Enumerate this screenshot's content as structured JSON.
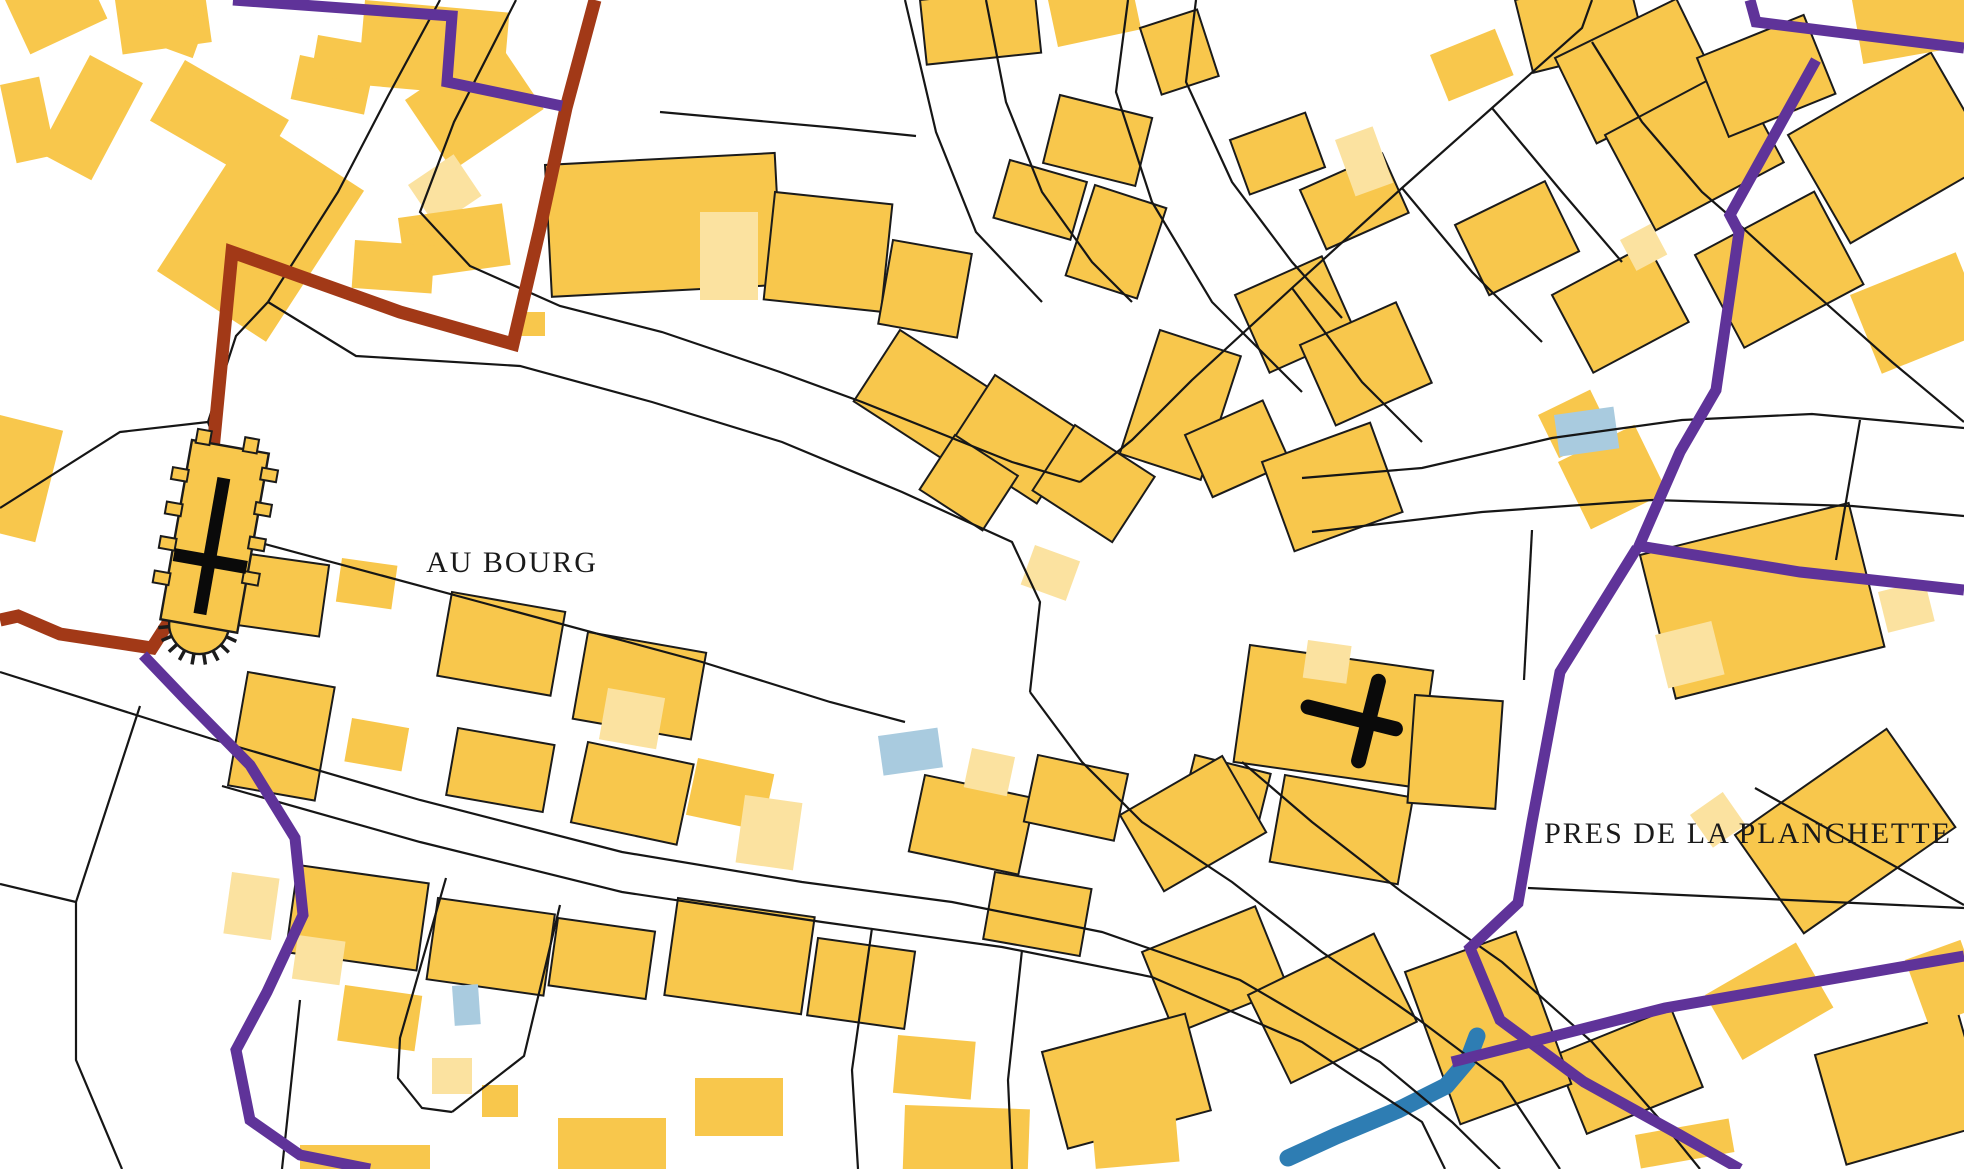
{
  "labels": {
    "au_bourg": {
      "text": "AU BOURG",
      "x": 512,
      "y": 572,
      "size": 30
    },
    "pres": {
      "text": "PRES DE LA PLANCHETTE",
      "x": 1748,
      "y": 843,
      "size": 30
    }
  },
  "map": {
    "palette": {
      "background": "#ffffff",
      "building": "#F8C74C",
      "building_light": "#FBE2A0",
      "building_lighter": "#FDEFCB",
      "outline": "#1b1b1b",
      "parcel_line": "#161616",
      "pool": "#A9CBDF",
      "stream": "#2E7DB3",
      "purple_boundary": "#5F3399",
      "brown_boundary": "#A23917",
      "symbol_black": "#0a0a0a",
      "text": "#1a1a1a"
    },
    "stroke_widths": {
      "parcel": 2.2,
      "purple": 11,
      "brown": 13,
      "stream": 17,
      "cross": 13,
      "calvary": 15
    },
    "buildings": [
      [
        5,
        0,
        85,
        60,
        -25,
        0,
        0
      ],
      [
        115,
        0,
        90,
        55,
        -8,
        0,
        0
      ],
      [
        150,
        0,
        60,
        40,
        20,
        0,
        0
      ],
      [
        365,
        0,
        145,
        85,
        5,
        0,
        0
      ],
      [
        90,
        55,
        60,
        110,
        28,
        0,
        0
      ],
      [
        185,
        60,
        120,
        70,
        30,
        0,
        0
      ],
      [
        300,
        55,
        75,
        45,
        12,
        0,
        0
      ],
      [
        255,
        120,
        130,
        180,
        33,
        0,
        0
      ],
      [
        0,
        85,
        40,
        80,
        -12,
        0,
        0
      ],
      [
        0,
        415,
        65,
        115,
        14,
        0,
        0
      ],
      [
        318,
        35,
        55,
        40,
        10,
        0,
        0
      ],
      [
        405,
        100,
        110,
        85,
        -34,
        0,
        0
      ],
      [
        408,
        185,
        55,
        50,
        -34,
        0,
        1
      ],
      [
        398,
        218,
        105,
        62,
        -8,
        0,
        0
      ],
      [
        355,
        240,
        80,
        48,
        4,
        0,
        0
      ],
      [
        545,
        165,
        230,
        132,
        -3,
        1,
        0
      ],
      [
        700,
        212,
        58,
        88,
        0,
        0,
        1
      ],
      [
        775,
        192,
        118,
        108,
        6,
        1,
        0
      ],
      [
        893,
        240,
        80,
        85,
        10,
        1,
        0
      ],
      [
        515,
        312,
        30,
        24,
        0,
        0,
        0
      ],
      [
        920,
        0,
        115,
        65,
        -6,
        1,
        0
      ],
      [
        1048,
        0,
        85,
        48,
        -12,
        0,
        0
      ],
      [
        1140,
        28,
        60,
        70,
        -18,
        1,
        0
      ],
      [
        1060,
        95,
        95,
        70,
        14,
        1,
        0
      ],
      [
        1010,
        160,
        80,
        60,
        16,
        1,
        0
      ],
      [
        1095,
        185,
        75,
        95,
        18,
        1,
        0
      ],
      [
        1230,
        140,
        80,
        58,
        -20,
        1,
        0
      ],
      [
        1300,
        190,
        90,
        65,
        -24,
        1,
        0
      ],
      [
        1335,
        140,
        40,
        60,
        -20,
        0,
        1
      ],
      [
        900,
        330,
        115,
        85,
        33,
        1,
        0
      ],
      [
        995,
        375,
        105,
        85,
        33,
        1,
        0
      ],
      [
        1075,
        425,
        95,
        78,
        33,
        1,
        0
      ],
      [
        955,
        435,
        75,
        65,
        33,
        1,
        0
      ],
      [
        1160,
        330,
        85,
        130,
        18,
        1,
        0
      ],
      [
        1235,
        295,
        95,
        85,
        -24,
        1,
        0
      ],
      [
        1300,
        345,
        105,
        88,
        -24,
        1,
        0
      ],
      [
        1185,
        435,
        85,
        68,
        -24,
        1,
        0
      ],
      [
        1262,
        462,
        115,
        95,
        -20,
        1,
        0
      ],
      [
        1035,
        545,
        48,
        42,
        20,
        0,
        1
      ],
      [
        1430,
        55,
        70,
        50,
        -22,
        0,
        0
      ],
      [
        1515,
        0,
        115,
        75,
        -14,
        1,
        0
      ],
      [
        1555,
        58,
        135,
        95,
        -26,
        1,
        0
      ],
      [
        1735,
        55,
        38,
        75,
        -22,
        0,
        1
      ],
      [
        1605,
        135,
        145,
        108,
        -28,
        1,
        0
      ],
      [
        1697,
        58,
        115,
        85,
        -22,
        1,
        0
      ],
      [
        1788,
        135,
        165,
        125,
        -30,
        1,
        0
      ],
      [
        1852,
        0,
        112,
        65,
        -10,
        0,
        0
      ],
      [
        1455,
        225,
        100,
        78,
        -26,
        1,
        0
      ],
      [
        1552,
        295,
        108,
        88,
        -28,
        1,
        0
      ],
      [
        1620,
        240,
        35,
        35,
        -28,
        0,
        1
      ],
      [
        1695,
        255,
        135,
        105,
        -28,
        1,
        0
      ],
      [
        1850,
        295,
        114,
        85,
        -22,
        0,
        0
      ],
      [
        1538,
        415,
        58,
        48,
        -26,
        0,
        0
      ],
      [
        1640,
        555,
        215,
        148,
        -14,
        1,
        0
      ],
      [
        1655,
        635,
        58,
        55,
        -14,
        0,
        1
      ],
      [
        1558,
        462,
        85,
        75,
        -26,
        0,
        0
      ],
      [
        1878,
        592,
        48,
        42,
        -14,
        0,
        1
      ],
      [
        1690,
        815,
        40,
        40,
        -35,
        0,
        1
      ],
      [
        1735,
        835,
        185,
        120,
        -35,
        1,
        0
      ],
      [
        1555,
        1055,
        125,
        85,
        -22,
        1,
        0
      ],
      [
        1705,
        995,
        105,
        75,
        -30,
        0,
        0
      ],
      [
        1815,
        1055,
        149,
        114,
        -16,
        1,
        0
      ],
      [
        1635,
        1135,
        95,
        34,
        -10,
        0,
        0
      ],
      [
        1905,
        960,
        59,
        70,
        -20,
        0,
        0
      ],
      [
        1250,
        645,
        185,
        118,
        8,
        1,
        0
      ],
      [
        1308,
        640,
        44,
        38,
        8,
        0,
        1
      ],
      [
        1285,
        775,
        130,
        88,
        10,
        1,
        0
      ],
      [
        1195,
        755,
        78,
        58,
        14,
        1,
        0
      ],
      [
        1415,
        695,
        88,
        108,
        4,
        1,
        0
      ],
      [
        925,
        775,
        112,
        78,
        12,
        1,
        0
      ],
      [
        972,
        748,
        44,
        40,
        12,
        0,
        1
      ],
      [
        1038,
        755,
        92,
        68,
        12,
        1,
        0
      ],
      [
        1120,
        815,
        118,
        88,
        -30,
        1,
        0
      ],
      [
        995,
        872,
        98,
        68,
        10,
        1,
        0
      ],
      [
        1142,
        952,
        122,
        88,
        -22,
        1,
        0
      ],
      [
        1248,
        995,
        140,
        98,
        -26,
        1,
        0
      ],
      [
        1405,
        972,
        118,
        162,
        -20,
        1,
        0
      ],
      [
        1042,
        1052,
        148,
        100,
        -15,
        1,
        0
      ],
      [
        898,
        1035,
        78,
        58,
        5,
        0,
        0
      ],
      [
        905,
        1105,
        125,
        64,
        2,
        0,
        0
      ],
      [
        1092,
        1125,
        84,
        44,
        -5,
        0,
        0
      ],
      [
        235,
        552,
        95,
        72,
        8,
        1,
        0
      ],
      [
        342,
        558,
        56,
        44,
        8,
        0,
        0
      ],
      [
        452,
        592,
        115,
        85,
        10,
        1,
        0
      ],
      [
        588,
        632,
        120,
        88,
        10,
        1,
        0
      ],
      [
        608,
        688,
        58,
        52,
        10,
        0,
        1
      ],
      [
        248,
        672,
        88,
        115,
        10,
        1,
        0
      ],
      [
        352,
        718,
        58,
        44,
        10,
        0,
        0
      ],
      [
        458,
        728,
        98,
        68,
        10,
        1,
        0
      ],
      [
        588,
        742,
        108,
        82,
        12,
        1,
        0
      ],
      [
        698,
        758,
        78,
        58,
        12,
        0,
        0
      ],
      [
        745,
        795,
        58,
        68,
        8,
        0,
        1
      ],
      [
        232,
        872,
        48,
        62,
        8,
        0,
        1
      ],
      [
        298,
        865,
        132,
        88,
        8,
        1,
        0
      ],
      [
        298,
        935,
        48,
        44,
        8,
        0,
        1
      ],
      [
        438,
        898,
        118,
        82,
        8,
        1,
        0
      ],
      [
        558,
        918,
        98,
        68,
        8,
        1,
        0
      ],
      [
        678,
        898,
        138,
        98,
        8,
        1,
        0
      ],
      [
        818,
        938,
        98,
        78,
        8,
        1,
        0
      ],
      [
        345,
        985,
        78,
        56,
        8,
        0,
        0
      ],
      [
        695,
        1078,
        88,
        58,
        0,
        0,
        0
      ],
      [
        558,
        1118,
        108,
        51,
        0,
        0,
        0
      ],
      [
        432,
        1058,
        40,
        36,
        0,
        0,
        1
      ],
      [
        482,
        1085,
        36,
        32,
        0,
        0,
        0
      ],
      [
        300,
        1145,
        130,
        24,
        0,
        0,
        0
      ]
    ],
    "pools": [
      [
        1554,
        415,
        60,
        42,
        -8
      ],
      [
        878,
        736,
        60,
        40,
        -8
      ],
      [
        452,
        986,
        26,
        40,
        -4
      ]
    ],
    "stream_points": "1288,1158 1336,1136 1398,1110 1446,1086 1468,1060 1477,1036",
    "parcel_lines": [
      "440,0 388,96 338,192 268,302",
      "516,0 454,122 420,212 470,266 560,306 662,332 780,372 862,402 922,426 1012,462 1080,482",
      "268,302 356,356 520,366 652,402 782,442 902,492 1012,542 1040,602 1030,692",
      "268,302 236,336 208,422",
      "208,422 250,540",
      "0,508 120,432 208,422",
      "250,540 480,602 702,662 830,702 905,722",
      "0,672 228,744",
      "228,744 420,800 622,852 802,882 952,902 1102,932 1240,980 1380,1062 1452,1122 1500,1169",
      "222,786 420,842 622,892 822,922 1002,947 1152,977 1302,1042 1422,1122 1445,1169",
      "140,706 76,902 76,1060 122,1169",
      "76,902 0,884",
      "300,1000 282,1169",
      "1080,482 1132,440 1192,380 1292,288 1402,188 1492,108 1582,28 1592,0",
      "1128,0 1116,92 1152,202 1212,302 1262,352 1302,392",
      "1196,0 1186,82 1232,182 1292,262 1342,318",
      "1302,478 1422,468 1552,438 1682,420 1812,414 1964,428",
      "1312,532 1482,512 1652,500 1852,506 1964,516",
      "1030,692 1082,762 1142,822 1232,882 1322,952 1422,1022 1502,1082 1560,1169",
      "1242,762 1312,822 1402,892 1502,962 1592,1042 1662,1122 1700,1169",
      "1592,42 1642,122 1702,192 1732,218",
      "1732,218 1802,282 1892,362 1964,422",
      "1492,108 1562,192 1622,262",
      "1402,188 1472,272 1542,342",
      "1292,288 1362,382 1422,442",
      "1528,888 1964,908",
      "1755,788 1964,905",
      "905,0 936,132 976,232 1042,302",
      "986,0 1006,102 1042,192 1092,262 1132,302",
      "660,112 838,128 916,136",
      "446,878 400,1038 398,1078 422,1108 452,1112",
      "560,905 524,1056 452,1112",
      "1532,530 1524,680",
      "1860,420 1836,560",
      "872,928 852,1070 858,1169",
      "1022,950 1008,1080 1012,1169"
    ],
    "purple_lines": [
      "233,0 452,16 447,82 562,106",
      "1750,0 1756,22 1964,48",
      "1816,60 1730,215 1739,232 1716,390 1680,452 1639,546 1800,572 1964,590",
      "1637,548 1560,672 1532,822 1518,903 1470,948 1500,1020 1584,1082 1680,1135 1740,1169",
      "143,655 186,700 250,765 295,838 303,915 267,992 236,1050 250,1120 300,1155 370,1169",
      "1452,1062 1665,1008 1964,956"
    ],
    "brown_line": "595,0 566,108 540,228 513,344 400,312 232,252 213,450 198,540 170,620 152,648 60,634 18,616 0,620",
    "church": {
      "transform": "rotate(10 192 440)",
      "body": [
        192,
        440,
        78,
        182
      ],
      "teeth": [
        [
          196,
          428,
          14,
          14
        ],
        [
          244,
          428,
          14,
          14
        ],
        [
          178,
          470,
          16,
          12
        ],
        [
          178,
          505,
          16,
          12
        ],
        [
          178,
          540,
          16,
          12
        ],
        [
          178,
          575,
          16,
          12
        ],
        [
          266,
          455,
          16,
          12
        ],
        [
          266,
          490,
          16,
          12
        ],
        [
          266,
          525,
          16,
          12
        ],
        [
          266,
          560,
          16,
          12
        ]
      ],
      "apse": {
        "cx": 231,
        "cy": 620,
        "r": 30,
        "tick_inner": 30,
        "tick_outer": 41,
        "ticks": 8
      },
      "cross_v": [
        230,
        472,
        230,
        610
      ],
      "cross_h": [
        194,
        556,
        268,
        556
      ]
    },
    "calvary": {
      "transform": "rotate(14 1360 722)",
      "h": [
        1306,
        720,
        1396,
        720
      ],
      "v": [
        1368,
        678,
        1368,
        760
      ]
    }
  }
}
